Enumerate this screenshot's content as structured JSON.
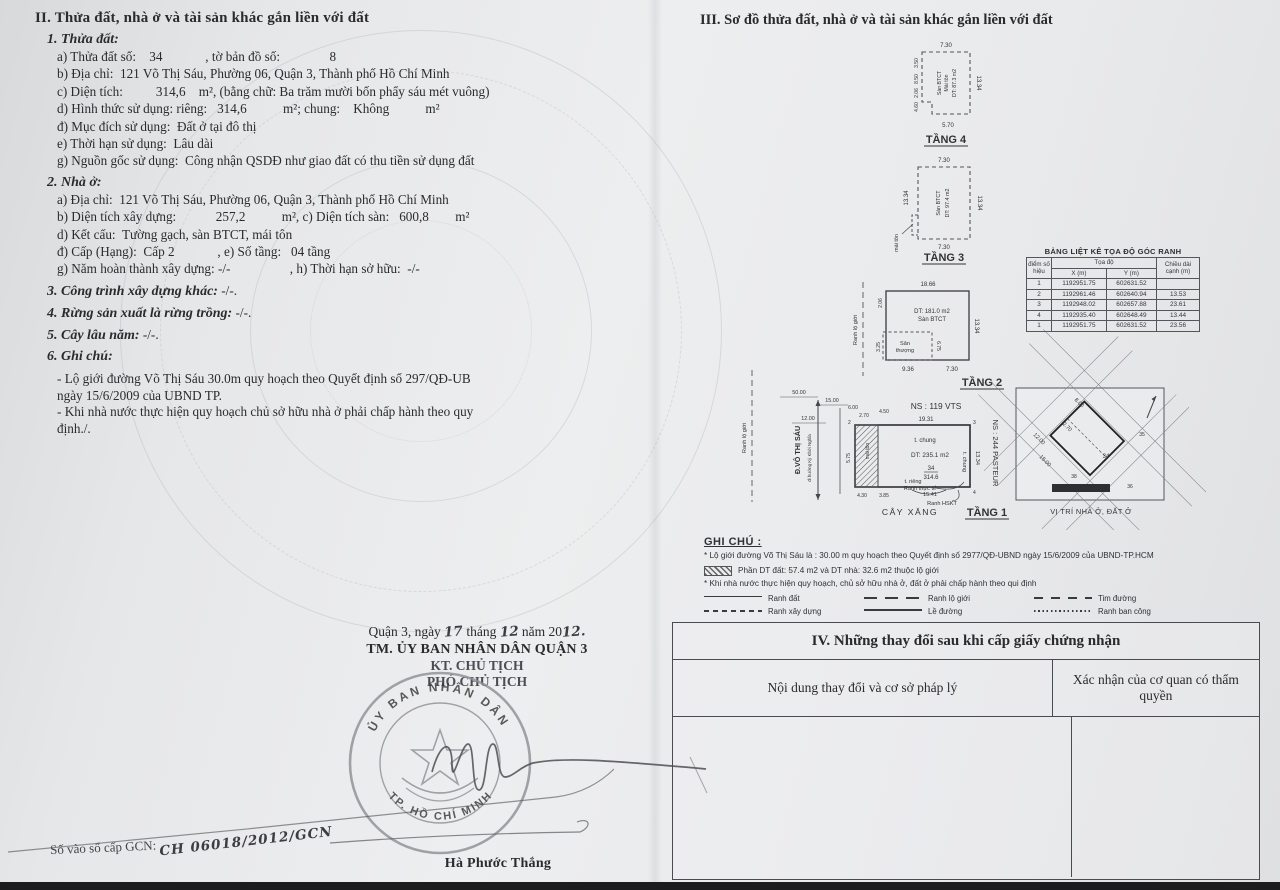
{
  "doc": {
    "sec2": {
      "title": "II. Thửa đất, nhà ở và tài sản khác gắn liền với đất",
      "h1": "1. Thửa đất:",
      "land_lines": [
        "a) Thửa đất số:    34             , tờ bản đồ số:               8",
        "b) Địa chỉ:  121 Võ Thị Sáu, Phường 06, Quận 3, Thành phố Hồ Chí Minh",
        "c) Diện tích:          314,6    m², (bằng chữ: Ba trăm mười bốn phẩy sáu mét vuông)",
        "d) Hình thức sử dụng: riêng:   314,6           m²; chung:    Không           m²",
        "đ) Mục đích sử dụng:  Đất ở tại đô thị",
        "e) Thời hạn sử dụng:  Lâu dài",
        "g) Nguồn gốc sử dụng:  Công nhận QSDĐ như giao đất có thu tiền sử dụng đất"
      ],
      "h2": "2. Nhà ở:",
      "house_lines": [
        "a) Địa chỉ:  121 Võ Thị Sáu, Phường 06, Quận 3, Thành phố Hồ Chí Minh",
        "b) Diện tích xây dựng:            257,2           m², c) Diện tích sàn:   600,8        m²",
        "d) Kết cấu:  Tường gạch, sàn BTCT, mái tôn",
        "đ) Cấp (Hạng):  Cấp 2             , e) Số tầng:   04 tầng",
        "g) Năm hoàn thành xây dựng: -/-                  , h) Thời hạn sở hữu:  -/-"
      ],
      "h3_label": "3. Công trình xây dựng khác:",
      "h3_value": " -/-.",
      "h4_label": "4. Rừng sản xuất là rừng trồng:",
      "h4_value": " -/-.",
      "h5_label": "5. Cây lâu năm:",
      "h5_value": " -/-.",
      "h6": "6. Ghi chú:",
      "notes": [
        "- Lộ giới đường Võ Thị Sáu 30.0m quy hoạch theo Quyết định số 297/QĐ-UB\nngày 15/6/2009 của UBND TP.",
        "- Khi nhà nước thực hiện quy hoạch chủ sở hữu nhà ở phải chấp hành theo quy\nđịnh./."
      ]
    },
    "sign": {
      "place": "Quận 3, ngày",
      "day": "17",
      "thang": "tháng",
      "month": "12",
      "nam": "năm 20",
      "year2": "12.",
      "committee": "TM. ỦY BAN NHÂN DÂN QUẬN 3",
      "kt": "KT. CHỦ TỊCH",
      "deputy": "PHÓ CHỦ TỊCH",
      "name": "Hà Phước Thắng",
      "book_label": "Số vào sổ cấp GCN:",
      "book_value": "CH 06018/2012/GCN"
    },
    "stamp": {
      "top_text": "ỦY BAN NHÂN DÂN",
      "bottom_text": "TP. HỒ CHÍ MINH"
    },
    "sec3": {
      "title": "III. Sơ đồ thửa đất, nhà ở và tài sản khác gắn liền với đất",
      "t4": {
        "top": "7.30",
        "right": "13.34",
        "bottom": "5.70",
        "l1": "3.50",
        "l2": "8.50",
        "l3": "2.06",
        "l4": "4.60",
        "in1": "Sàn BTCT",
        "in2": "Mái tôn",
        "in3": "DT: 87.3 m2",
        "label": "TẦNG 4"
      },
      "t3": {
        "top": "7.30",
        "right": "13.34",
        "bottom": "7.30",
        "left": "13.34",
        "in1": "Sàn BTCT",
        "in2": "DT: 97.4 m2",
        "note": "mái tôn",
        "label": "TẦNG 3"
      },
      "t2": {
        "top": "18.66",
        "right": "13.34",
        "b1": "9.36",
        "b2": "7.30",
        "l1": "2.06",
        "l2": "3.25",
        "mid": "6.75",
        "in1": "DT: 181.0 m2",
        "in2": "Sàn BTCT",
        "ter1": "Sân",
        "ter2": "thượng",
        "boundary": "Ranh lộ giới",
        "label": "TẦNG 2"
      },
      "t1": {
        "ns_top": "NS : 119 VTS",
        "dim_top": "19.31",
        "c2": "2",
        "c3": "3",
        "c4": "4",
        "chung_top": "t. chung",
        "area": "DT: 235.1 m2",
        "parcel": "34",
        "parcel_area": "314.6",
        "ranh_tt": "Ranh thực tế",
        "t_rieng": "t. riêng",
        "chung_right": "t. chung",
        "dim_right": "13.34",
        "ns_right": "NS : 244 PASTEUR",
        "dim_bottom": "15.41",
        "ranh_hskt": "Ranh HSKT",
        "gas": "CÂY XĂNG",
        "label": "TẦNG 1",
        "street": "Đ.VÔ THỊ SÁU",
        "street_note": "đi hướng Kỳ Khởi Nghĩa",
        "boundary": "Ranh lộ giới",
        "mai_ton": "mái tôn",
        "d50": "50.00",
        "d15": "15.00",
        "d6": "6.00",
        "d12": "12.00",
        "d270": "2.70",
        "d450": "4.50",
        "d430": "4.30",
        "d385": "3.85",
        "d575": "5.75"
      },
      "table": {
        "title": "BẢNG LIỆT KÊ TỌA ĐỘ GÓC RANH",
        "c_point": "điểm số hiệu",
        "c_coord": "Tọa độ",
        "c_x": "X (m)",
        "c_y": "Y (m)",
        "c_len": "Chiều dài cạnh (m)",
        "rows": [
          {
            "pt": "1",
            "x": "1192951.75",
            "y": "602631.52",
            "len": ""
          },
          {
            "pt": "2",
            "x": "1192961.46",
            "y": "602640.94",
            "len": "13.53"
          },
          {
            "pt": "3",
            "x": "1192948.02",
            "y": "602657.88",
            "len": "23.61"
          },
          {
            "pt": "4",
            "x": "1192935.40",
            "y": "602648.49",
            "len": "13.44"
          },
          {
            "pt": "1",
            "x": "1192951.75",
            "y": "602631.52",
            "len": "23.56"
          }
        ]
      },
      "inset": {
        "caption": "VỊ TRÍ NHÀ Ở, ĐẤT Ở",
        "n34": "34",
        "n38": "38",
        "n36": "36",
        "n35": "35",
        "d800": "8.00",
        "d270": "2.70",
        "d1200": "12.00",
        "d1500": "15.00"
      },
      "gc": {
        "heading": "GHI CHÚ :",
        "line1": "* Lộ giới đường Võ Thị Sáu là : 30.00 m quy hoạch theo Quyết định số 2977/QĐ-UBND ngày 15/6/2009 của UBND-TP.HCM",
        "hatch_note": "Phần DT đất: 57.4 m2 và DT nhà: 32.6 m2 thuộc lộ giới",
        "line2": "* Khi nhà nước thực hiện quy hoạch, chủ sở hữu nhà ở, đất ở phải chấp hành theo qui định",
        "legend": [
          "Ranh đất",
          "Ranh lộ giới",
          "Tim đường",
          "Ranh xây dựng",
          "Lề đường",
          "Ranh ban công"
        ]
      }
    },
    "sec4": {
      "title": "IV. Những thay đổi sau khi cấp giấy chứng nhận",
      "col1": "Nội dung thay đổi và cơ sở pháp lý",
      "col2": "Xác nhận của cơ quan có thẩm quyền"
    }
  }
}
